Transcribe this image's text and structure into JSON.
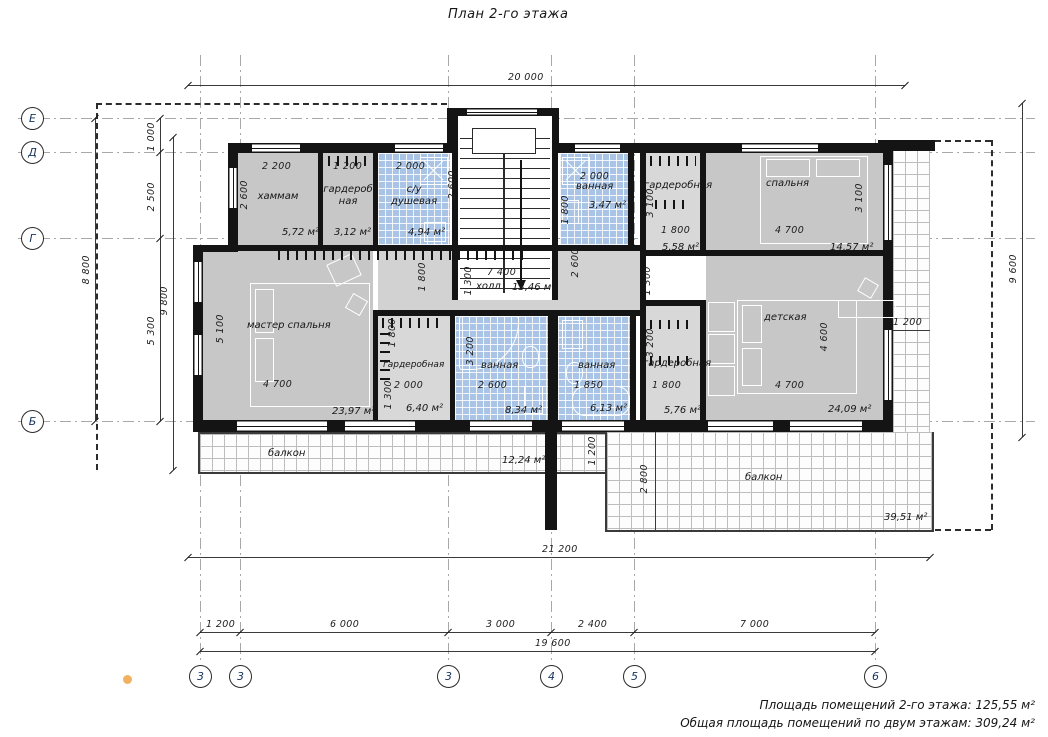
{
  "title": "План 2-го этажа",
  "axes": {
    "left": [
      "Е",
      "Д",
      "Г",
      "Б"
    ],
    "bottom": [
      "3",
      "3",
      "3",
      "4",
      "5",
      "6"
    ]
  },
  "rooms": {
    "hammam": {
      "label": "хаммам",
      "area": "5,72 м²"
    },
    "wardrobe_top": {
      "label": "гардероб ная",
      "area": "3,12 м²"
    },
    "shower": {
      "label": "с/у душевая",
      "area": "4,94 м²"
    },
    "bath_top": {
      "label": "ванная",
      "area": "3,47 м²"
    },
    "wardrobe_tr": {
      "label": "гардеробная",
      "area": "5,58 м²"
    },
    "bedroom": {
      "label": "спальня",
      "area": "14,57 м²"
    },
    "master": {
      "label": "мастер спальня",
      "area": "23,97 м²"
    },
    "hall": {
      "label": "холл",
      "area": "13,46 м²"
    },
    "wardrobe_mid": {
      "label": "гардеробная",
      "area": "6,40 м²"
    },
    "bath_center": {
      "label": "ванная",
      "area": "8,34 м²"
    },
    "bath_right": {
      "label": "ванная",
      "area": "6,13 м²"
    },
    "wardrobe_right": {
      "label": "гардеробная",
      "area": "5,76 м²"
    },
    "nursery": {
      "label": "детская",
      "area": "24,09 м²"
    },
    "balcony_left": {
      "label": "балкон",
      "area": "12,24 м²"
    },
    "balcony_right": {
      "label": "балкон",
      "area": "39,51 м²"
    }
  },
  "dims": {
    "top_overall": "20 000",
    "left_overall": "8 800",
    "left_e_d": "1 000",
    "left_d_g": "2 500",
    "left_g_b": "5 300",
    "left_inner": "9 800",
    "right_overall": "9 600",
    "right_strip": "1 200",
    "bottom_total": "21 200",
    "bottom_seg1": "1 200",
    "bottom_seg2": "6 000",
    "bottom_seg3": "3 000",
    "bottom_seg4": "2 400",
    "bottom_seg5": "7 000",
    "bottom_inner": "19 600",
    "hammam_w": "2 200",
    "hammam_h": "2 600",
    "wardrobe_top_w": "1 200",
    "shower_w": "2 000",
    "shower_h": "2 600",
    "bath_top_w": "2 000",
    "bath_top_h": "1 800",
    "wardrobe_tr_h": "3 100",
    "wardrobe_tr_w": "1 800",
    "bedroom_w": "4 700",
    "bedroom_h": "3 100",
    "hall_w": "7 400",
    "hall_h": "1 300",
    "hall_left_v": "1 800",
    "hall_v1": "2 600",
    "spine_h": "1 300",
    "master_w": "4 700",
    "master_h": "5 100",
    "wardrobe_mid_h": "1 800",
    "wardrobe_mid_w": "2 000",
    "wardrobe_mid_h2": "1 300",
    "bath_center_w": "2 600",
    "bath_center_h": "3 200",
    "bath_right_w": "1 850",
    "wardrobe_right_h": "3 200",
    "wardrobe_right_w": "1 800",
    "nursery_h": "4 600",
    "nursery_w": "4 700",
    "balcony_left_h": "1 200",
    "balcony_right_h": "2 800"
  },
  "summary": {
    "line1": "Площадь помещений 2-го этажа: 125,55 м²",
    "line2": "Общая площадь помещений по двум этажам: 309,24 м²"
  },
  "colors": {
    "tile_blue": "#a9c4e5",
    "room_gray": "#c7c7c7",
    "wall": "#141414",
    "accent_dot": "#f2b061"
  }
}
